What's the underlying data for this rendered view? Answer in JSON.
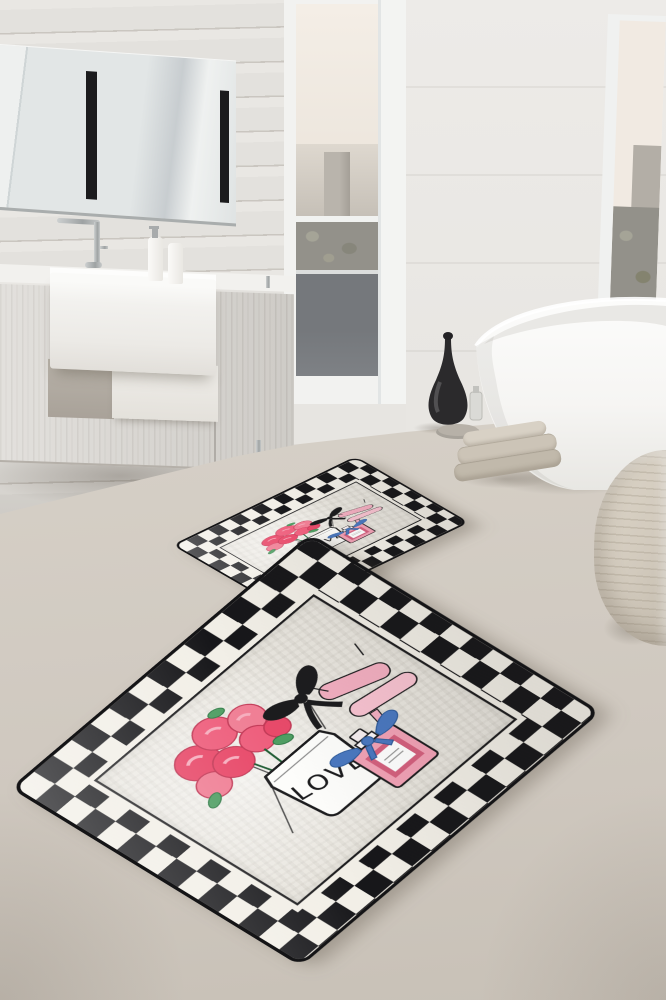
{
  "meta": {
    "kind": "product-photo",
    "subject": "Two-piece bathroom mat set with black-white checkerboard border and LOVE perfume-and-roses motif, staged in a modern bathroom",
    "canvas": {
      "width": 666,
      "height": 1000
    }
  },
  "palette": {
    "wall": "#ebe9e6",
    "wood": "#e3e1dd",
    "woodline": "#cac6c0",
    "mirror": "#e2e6e6",
    "sky": "#f1eae2",
    "city": "#c6c0b7",
    "trees": "#93918a",
    "balcony": "#75787c",
    "cabinet": "#d9d6d1",
    "floor": "#d7d1c8",
    "tub": "#fafaf8",
    "vaseblack": "#2b2a2c",
    "towel": "#cbc3b6",
    "pouf": "#d2cabd",
    "rugblack": "#17171a",
    "rugwhite": "#f2efe7",
    "rugfield": "#e9e6df",
    "ink": "#1c1c1e",
    "rose1": "#e84a6a",
    "rose2": "#f07f95",
    "rose3": "#ee5f7d",
    "roselight": "#f6aebe",
    "leaf": "#4f9e63",
    "heel": "#f3afc1",
    "heellight": "#f8c3d1",
    "perfume": "#f2a2b6",
    "perfumedark": "#d4607e",
    "bowblue": "#4a78c0",
    "chrome": "#b7babb"
  },
  "scene": {
    "objects": [
      {
        "name": "plank-wall",
        "label": "whitewashed wood plank wall"
      },
      {
        "name": "mirror",
        "label": "wide wall mirror with two vertical black light strips"
      },
      {
        "name": "vanity",
        "label": "wall-hung wood vanity with white farmhouse sink"
      },
      {
        "name": "faucet",
        "label": "chrome faucet"
      },
      {
        "name": "dispensers",
        "label": "two white toiletry bottles"
      },
      {
        "name": "window-middle",
        "label": "tall window with hazy city view and dark balcony panel"
      },
      {
        "name": "window-right",
        "label": "window with city and treetop view"
      },
      {
        "name": "bathtub",
        "label": "white freestanding oval bathtub"
      },
      {
        "name": "vase",
        "label": "black teardrop decorative vase with small glass bottle"
      },
      {
        "name": "towels",
        "label": "stack of folded beige towels"
      },
      {
        "name": "pouf",
        "label": "woven beige pouf"
      },
      {
        "name": "bath-mats",
        "label": "two checkerboard-bordered bath mats on the floor"
      }
    ]
  },
  "rug_design": {
    "love_text": "LOVE",
    "border_style": "double row black and white checkerboard with black trim",
    "motifs": [
      "pink rose bouquet",
      "white jar with LOVE lettering",
      "black ribbon bow",
      "pair of pink high heels",
      "pink perfume bottle with blue bow"
    ]
  }
}
